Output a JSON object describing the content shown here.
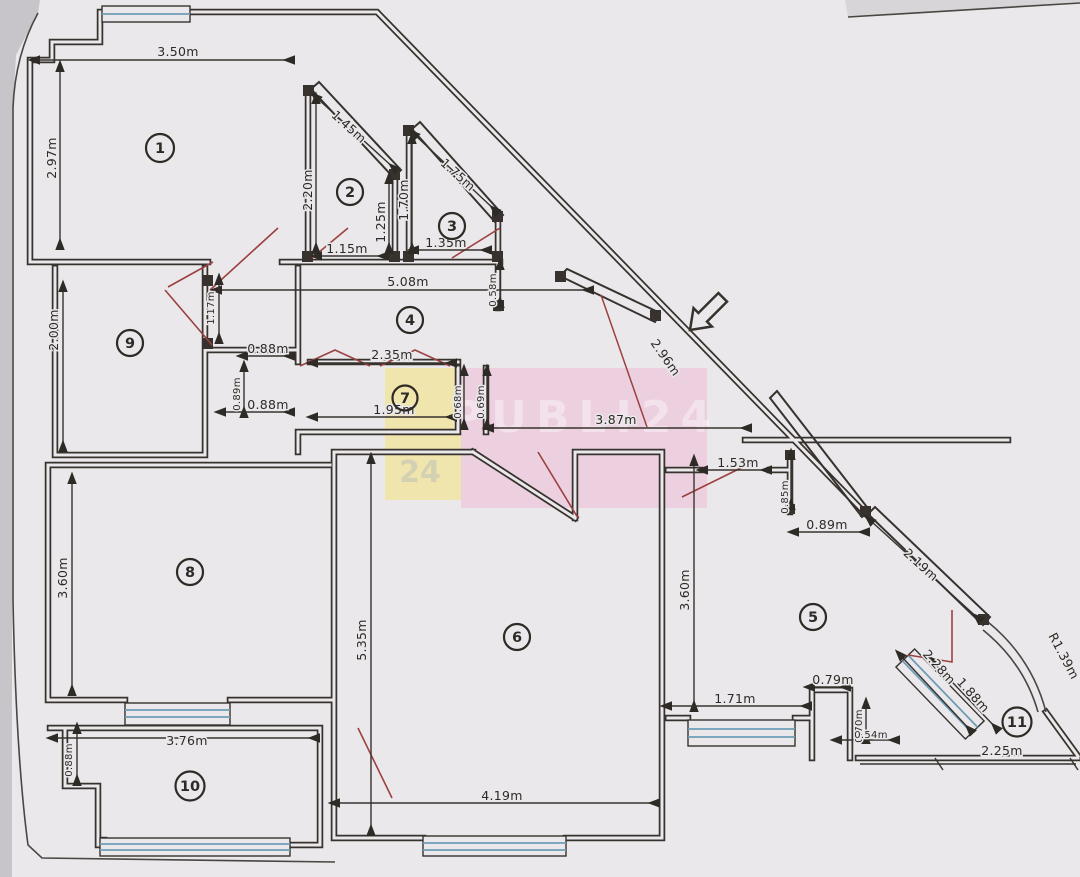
{
  "document": {
    "kind": "scanned apartment floor plan",
    "units": "meters"
  },
  "watermark": {
    "text": "PUBLI24",
    "yellow": "#f1e49e",
    "pink": "#eec2d8",
    "accent_blue": "#5b79c9"
  },
  "colors": {
    "paper": "#eae8ea",
    "margin": "#c7c5c9",
    "wall": "#37322e",
    "window": "#6f9cb5",
    "door_swing": "#9c4040",
    "dim_text": "#2e2a26"
  },
  "rooms": [
    {
      "number": "1"
    },
    {
      "number": "2"
    },
    {
      "number": "3"
    },
    {
      "number": "4"
    },
    {
      "number": "5"
    },
    {
      "number": "6"
    },
    {
      "number": "7"
    },
    {
      "number": "8"
    },
    {
      "number": "9"
    },
    {
      "number": "10"
    },
    {
      "number": "11"
    }
  ],
  "dims": [
    {
      "value": "3.50m"
    },
    {
      "value": "2.97m"
    },
    {
      "value": "1.45m"
    },
    {
      "value": "2.20m"
    },
    {
      "value": "1.25m"
    },
    {
      "value": "1.15m"
    },
    {
      "value": "1.70m"
    },
    {
      "value": "1.75m"
    },
    {
      "value": "1.35m"
    },
    {
      "value": "0.58m"
    },
    {
      "value": "5.08m"
    },
    {
      "value": "1.17m"
    },
    {
      "value": "2.96m"
    },
    {
      "value": "0.88m"
    },
    {
      "value": "0.89m"
    },
    {
      "value": "0.88m"
    },
    {
      "value": "2.35m"
    },
    {
      "value": "1.95m"
    },
    {
      "value": "0.68m"
    },
    {
      "value": "0.69m"
    },
    {
      "value": "3.87m"
    },
    {
      "value": "1.53m"
    },
    {
      "value": "0.85m"
    },
    {
      "value": "0.89m"
    },
    {
      "value": "2.19m"
    },
    {
      "value": "2.00m"
    },
    {
      "value": "3.60m"
    },
    {
      "value": "5.35m"
    },
    {
      "value": "3.60m"
    },
    {
      "value": "3.76m"
    },
    {
      "value": "0.88m"
    },
    {
      "value": "4.19m"
    },
    {
      "value": "1.71m"
    },
    {
      "value": "0.79m"
    },
    {
      "value": "0.70m"
    },
    {
      "value": "0.54m"
    },
    {
      "value": "2.28m"
    },
    {
      "value": "1.88m"
    },
    {
      "value": "2.25m"
    },
    {
      "value": "R1.39m"
    }
  ]
}
